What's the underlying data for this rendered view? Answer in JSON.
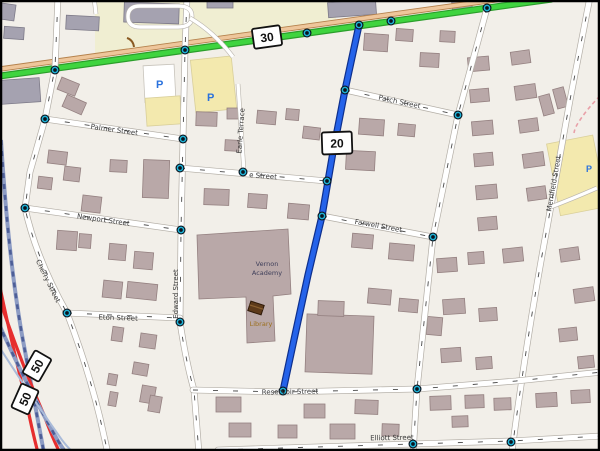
{
  "map": {
    "route_shields": {
      "route_30": "30",
      "route_20": "20",
      "route_50_upper": "50",
      "route_50_lower": "50"
    },
    "streets": {
      "palmer": "Palmer Street",
      "newport": "Newport Street",
      "eton": "Eton Street",
      "cherry": "Cherry Street",
      "edward": "Edward Street",
      "e_street": "e Street",
      "earle_terrace": "Earle Terrace",
      "patch": "Patch Street",
      "farwell": "Farwell Street",
      "reservoir": "Reservoir Street",
      "elliott": "Elliott Street",
      "merrifield": "Merrifield Street"
    },
    "places": {
      "academy_line1": "Vernon",
      "academy_line2": "Academy",
      "library": "Library"
    },
    "icons": {
      "parking": "P"
    },
    "colors": {
      "map_background": "#f2efe9",
      "land_yellow": "#f0eed2",
      "parking_yellow": "#f3e9ae",
      "building": "#b9a8a8",
      "building_gray": "#a5a2b0",
      "trunk_green": "#3fd43f",
      "parallel_road_tan": "#eec69b",
      "highlight_route_blue": "#2563ea",
      "motorway_red": "#e62e2e",
      "railway_blue": "#8d9cc4",
      "junction_node_cyan": "#1fb4d8"
    }
  }
}
